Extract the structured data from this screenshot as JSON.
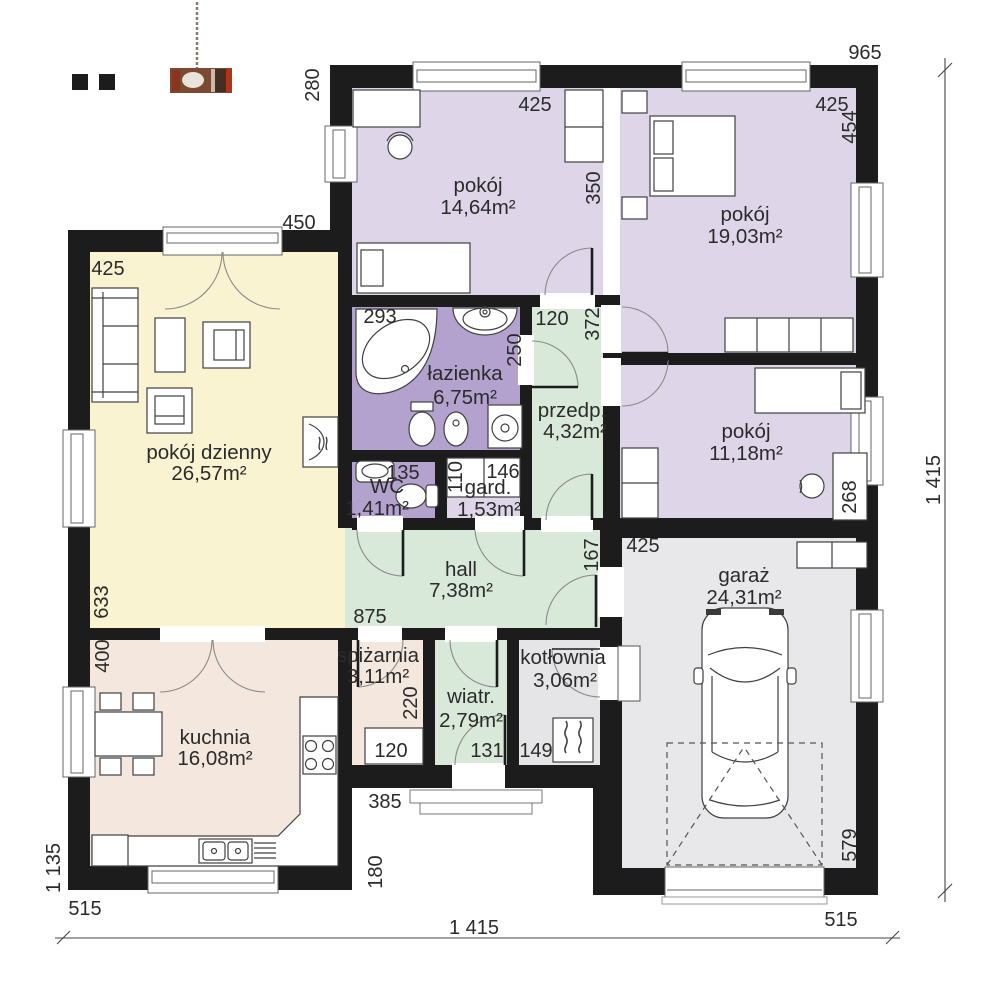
{
  "plan_title": "Rzut parteru",
  "colors": {
    "wall": "#1c1c1c",
    "bedroom": "#ded6e8",
    "bathroom": "#b3a2ce",
    "hallway": "#d8e8d9",
    "living": "#faf3d2",
    "kitchen": "#f4e7de",
    "garage": "#e8e8ea",
    "boiler": "#e5e5e7"
  },
  "rooms": [
    {
      "key": "pokoj-1",
      "name": "pokój",
      "area": "14,64m²"
    },
    {
      "key": "pokoj-2",
      "name": "pokój",
      "area": "19,03m²"
    },
    {
      "key": "pokoj-3",
      "name": "pokój",
      "area": "11,18m²"
    },
    {
      "key": "lazienka",
      "name": "łazienka",
      "area": "6,75m²"
    },
    {
      "key": "przedpokoj",
      "name": "przedp.",
      "area": "4,32m²"
    },
    {
      "key": "wc",
      "name": "WC",
      "area": "1,41m²"
    },
    {
      "key": "garderoba",
      "name": "gard.",
      "area": "1,53m²"
    },
    {
      "key": "hall",
      "name": "hall",
      "area": "7,38m²"
    },
    {
      "key": "pokoj-dzienny",
      "name": "pokój dzienny",
      "area": "26,57m²"
    },
    {
      "key": "kuchnia",
      "name": "kuchnia",
      "area": "16,08m²"
    },
    {
      "key": "spizarnia",
      "name": "spiżarnia",
      "area": "3,11m²"
    },
    {
      "key": "wiatrolap",
      "name": "wiatr.",
      "area": "2,79m²"
    },
    {
      "key": "kotlownia",
      "name": "kotłownia",
      "area": "3,06m²"
    },
    {
      "key": "garaz",
      "name": "garaż",
      "area": "24,31m²"
    }
  ],
  "dimensions": {
    "d965": "965",
    "d280": "280",
    "d450": "450",
    "d425_living": "425",
    "d425_room1": "425",
    "d425_room2": "425",
    "d454": "454",
    "d350": "350",
    "d120_przedp": "120",
    "d372": "372",
    "d293": "293",
    "d250": "250",
    "d135": "135",
    "d110": "110",
    "d146": "146",
    "d268": "268",
    "d425_garage": "425",
    "d633": "633",
    "d875": "875",
    "d167": "167",
    "d400": "400",
    "d220": "220",
    "d120_spizarnia": "120",
    "d131": "131",
    "d149": "149",
    "d579": "579",
    "d385": "385",
    "d180": "180",
    "d1135": "1 135",
    "d515_left": "515",
    "d515_right": "515",
    "d1415_bottom": "1 415",
    "d1415_right": "1 415"
  }
}
